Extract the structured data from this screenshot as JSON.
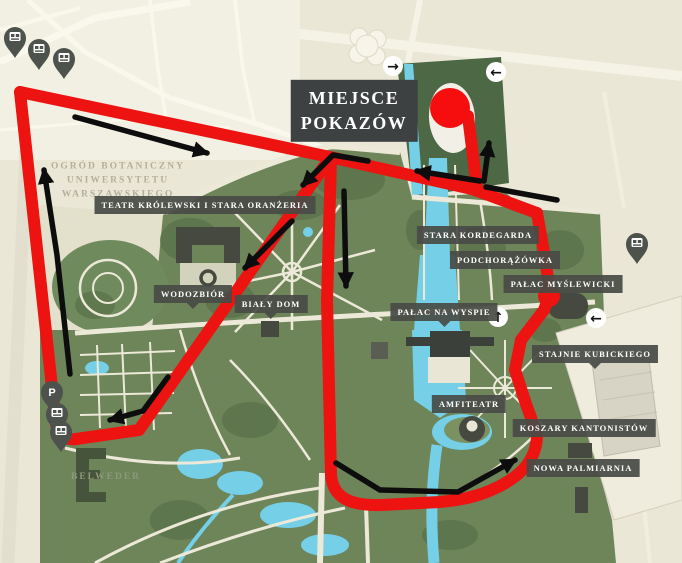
{
  "title": {
    "line1": "MIEJSCE",
    "line2": "POKAZÓW"
  },
  "map_labels": {
    "teatr": "TEATR KRÓLEWSKI I STARA ORANŻERIA",
    "wodozbior": "WODOZBIÓR",
    "bialy_dom": "BIAŁY DOM",
    "palac_na_wyspie": "PAŁAC NA WYSPIE",
    "stara_kordegarda": "STARA KORDEGARDA",
    "podchorazowka": "PODCHORĄŻÓWKA",
    "palac_myslewicki": "PAŁAC MYŚLEWICKI",
    "stajnie": "STAJNIE KUBICKIEGO",
    "amfiteatr": "AMFITEATR",
    "koszary": "KOSZARY KANTONISTÓW",
    "nowa_palmiarnia": "NOWA PALMIARNIA"
  },
  "area_labels": {
    "ogrod_line1": "OGRÓD BOTANICZNY",
    "ogrod_line2": "UNIWERSYTETU",
    "ogrod_line3": "WARSZAWSKIEGO",
    "belweder": "BELWEDER"
  },
  "nav_arrows": {
    "right": "→",
    "left": "←",
    "up": "↑",
    "left2": "←"
  },
  "markers": {
    "parking_label": "P"
  },
  "colors": {
    "route_red": "#ec1311",
    "arrow_black": "#0d0d0d",
    "label_bg": "#484b46",
    "water": "#74cfe7",
    "park_green": "#6e8459",
    "stadium_green": "#4d6845",
    "background": "#eae7d6"
  }
}
